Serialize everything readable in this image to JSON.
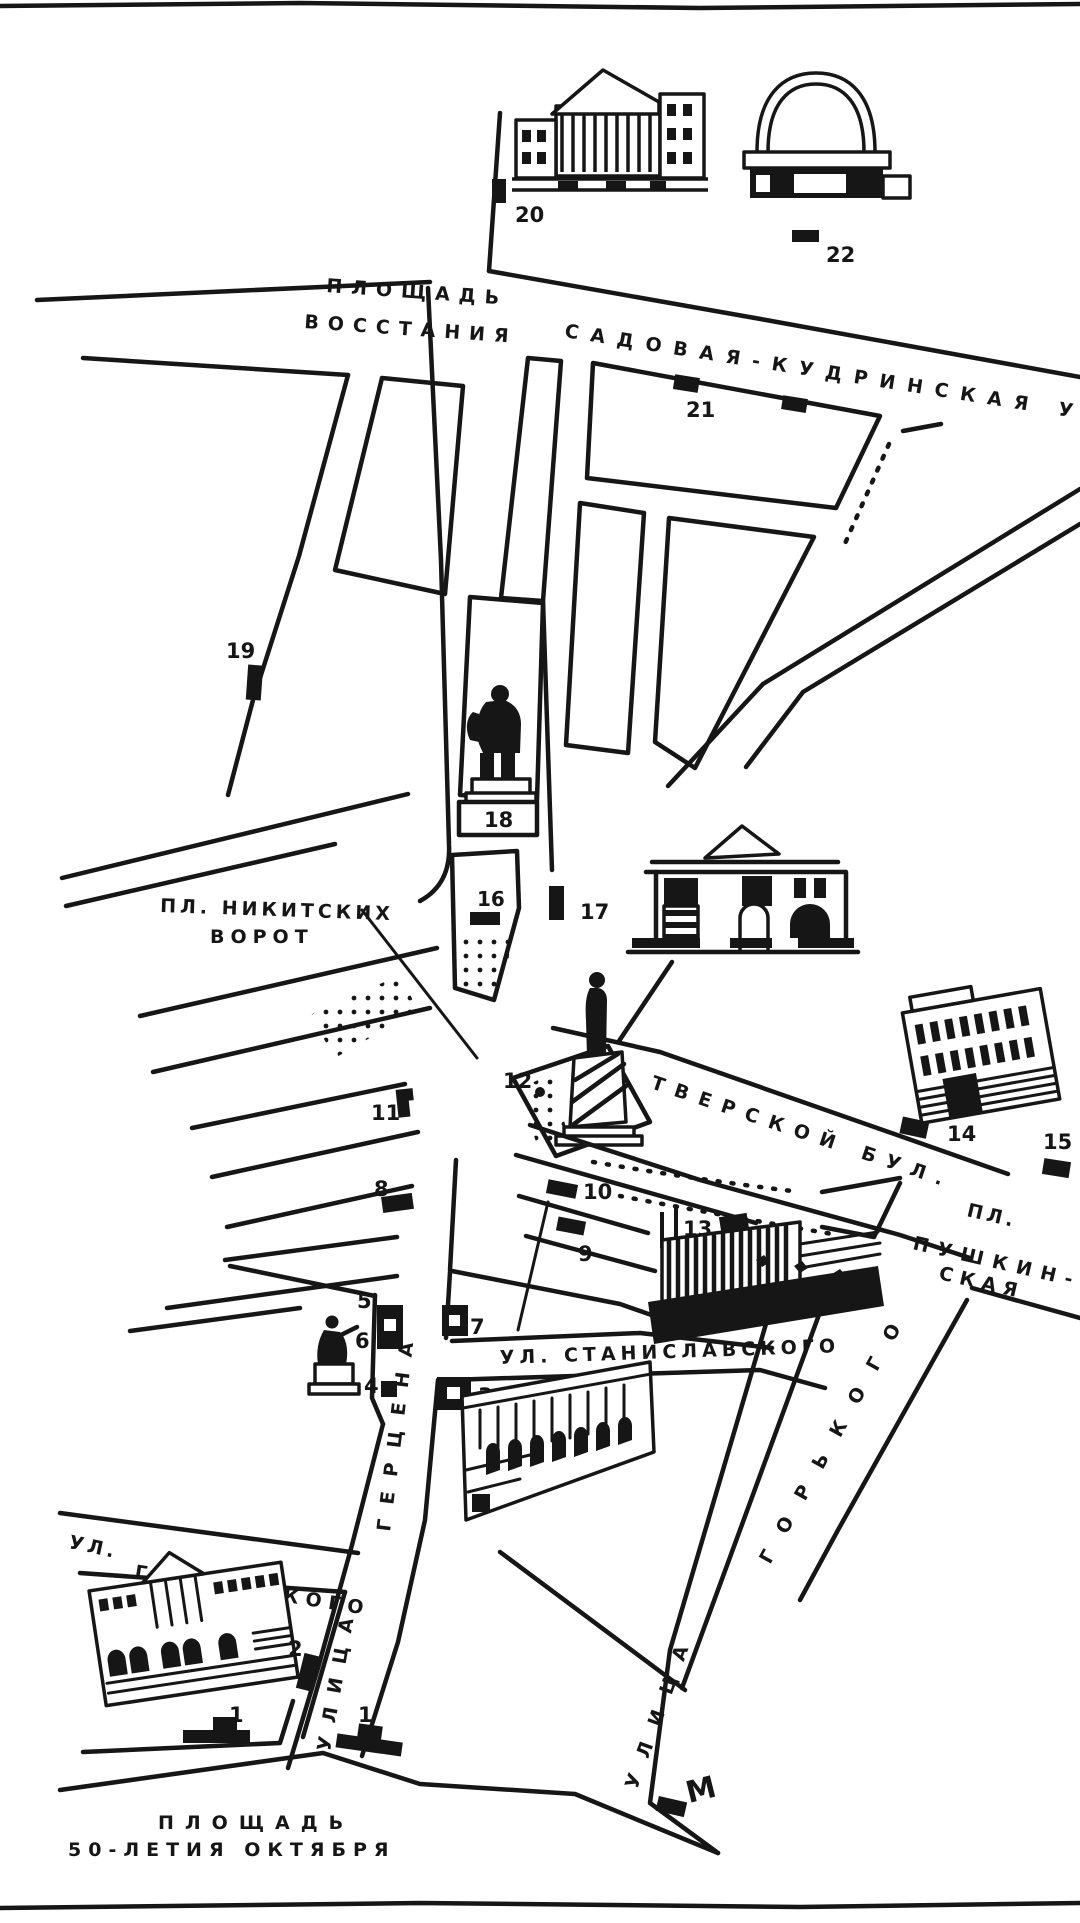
{
  "colors": {
    "ink": "#161616",
    "paper": "#ffffff"
  },
  "map": {
    "streets": {
      "vosstaniya_l1": "ПЛОЩАДЬ",
      "vosstaniya_l2": "ВОССТАНИЯ",
      "sadovaya": "САДОВАЯ-КУДРИНСКАЯ УЛ",
      "nikitskie_l1": "ПЛ. НИКИТСКИХ",
      "nikitskie_l2": "ВОРОТ",
      "tverskoy": "ТВЕРСКОЙ БУЛ.",
      "pushkinskaya_l1": "ПЛ.",
      "pushkinskaya_l2": "ПУШКИН-",
      "pushkinskaya_l3": "СКАЯ",
      "stanislavskogo": "УЛ. СТАНИСЛАВСКОГО",
      "gertsena_ulitsa": "УЛИЦА",
      "gertsena_name": "ГЕРЦЕНА",
      "granovskogo_l1": "УЛ.",
      "granovskogo_l2": "ГРАНОВСКОГО",
      "gorkogo_ulitsa": "УЛИЦА",
      "gorkogo_name": "ГОРЬКОГО",
      "oktyabrya_l1": "ПЛОЩАДЬ",
      "oktyabrya_l2": "50-ЛЕТИЯ ОКТЯБРЯ"
    },
    "metro": "М",
    "markers": [
      {
        "n": "1"
      },
      {
        "n": "1"
      },
      {
        "n": "2"
      },
      {
        "n": "3"
      },
      {
        "n": "4"
      },
      {
        "n": "5"
      },
      {
        "n": "6"
      },
      {
        "n": "7"
      },
      {
        "n": "8"
      },
      {
        "n": "9"
      },
      {
        "n": "10"
      },
      {
        "n": "11"
      },
      {
        "n": "12"
      },
      {
        "n": "13"
      },
      {
        "n": "14"
      },
      {
        "n": "15"
      },
      {
        "n": "16"
      },
      {
        "n": "17"
      },
      {
        "n": "18"
      },
      {
        "n": "19"
      },
      {
        "n": "20"
      },
      {
        "n": "21"
      },
      {
        "n": "22"
      }
    ]
  }
}
